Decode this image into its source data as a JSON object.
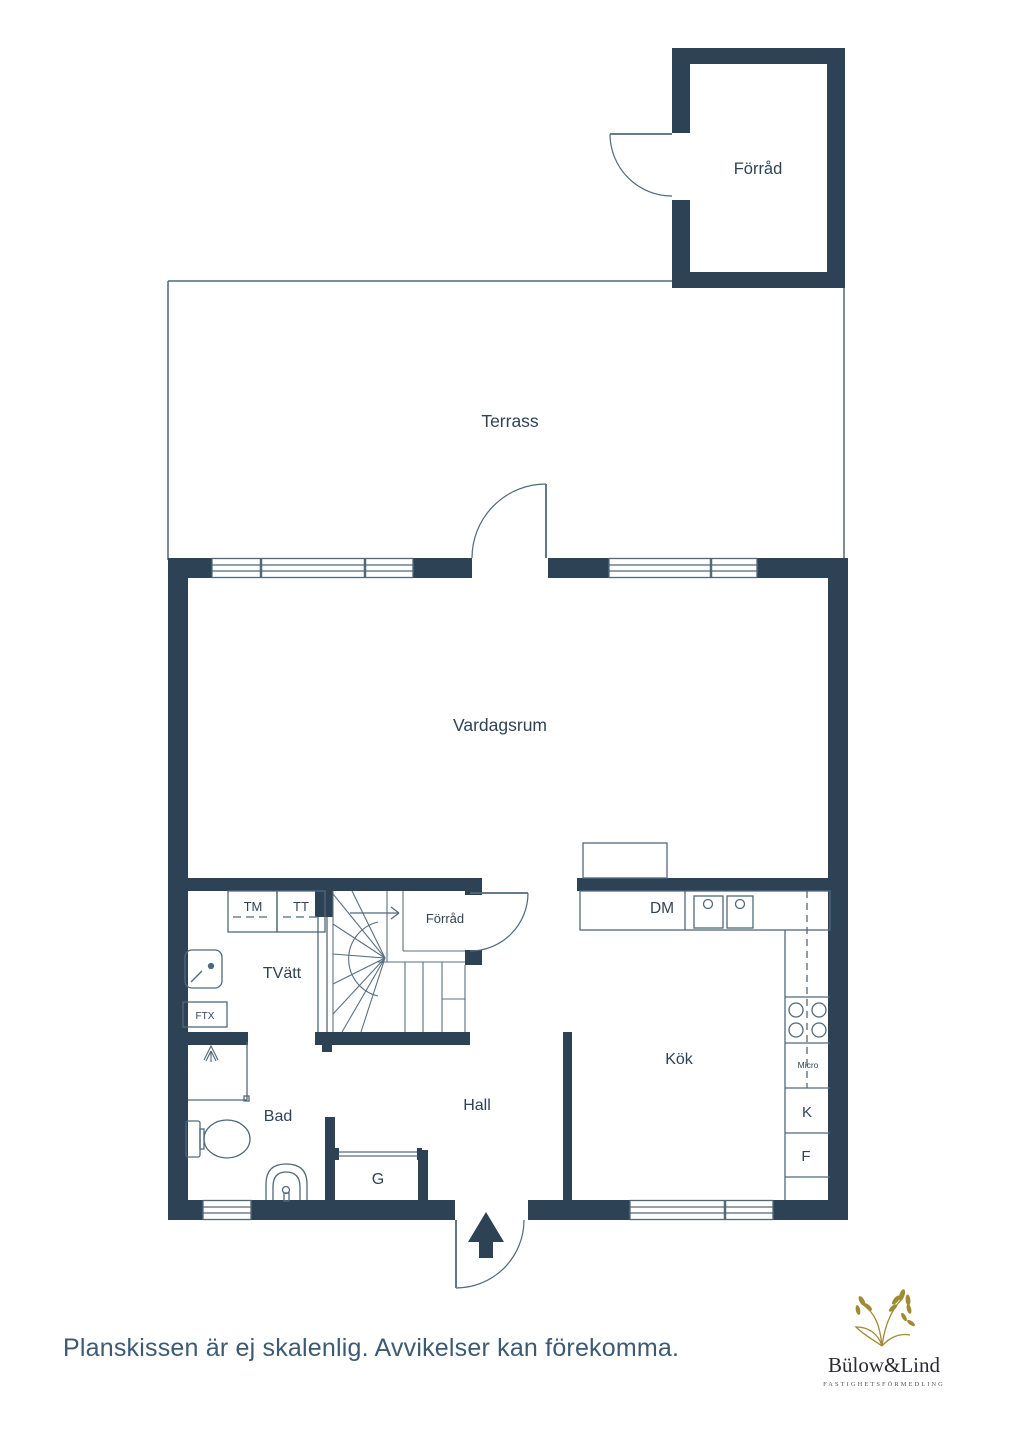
{
  "colors": {
    "wall": "#2d4254",
    "thin_line": "#51697b",
    "label_text": "#2e4456",
    "disclaimer_text": "#3c5a72",
    "logo_gold": "#a08a33",
    "logo_text": "#2b2b33",
    "logo_tagline_text": "#55555c"
  },
  "plan": {
    "rooms": {
      "terrass": "Terrass",
      "vardagsrum": "Vardagsrum",
      "forrad_top": "Förråd",
      "forrad_understairs": "Förråd",
      "tvatt": "TVätt",
      "bad": "Bad",
      "hall": "Hall",
      "kok": "Kök",
      "garderob": "G"
    },
    "appliances": {
      "tm": "TM",
      "tt": "TT",
      "ftx": "FTX",
      "dm": "DM",
      "micro": "Micro",
      "kyl": "K",
      "frys": "F"
    }
  },
  "footer": {
    "disclaimer": "Planskissen är ej skalenlig. Avvikelser kan förekomma."
  },
  "logo": {
    "name": "Bülow&Lind",
    "tagline": "FASTIGHETSFÖRMEDLING"
  }
}
